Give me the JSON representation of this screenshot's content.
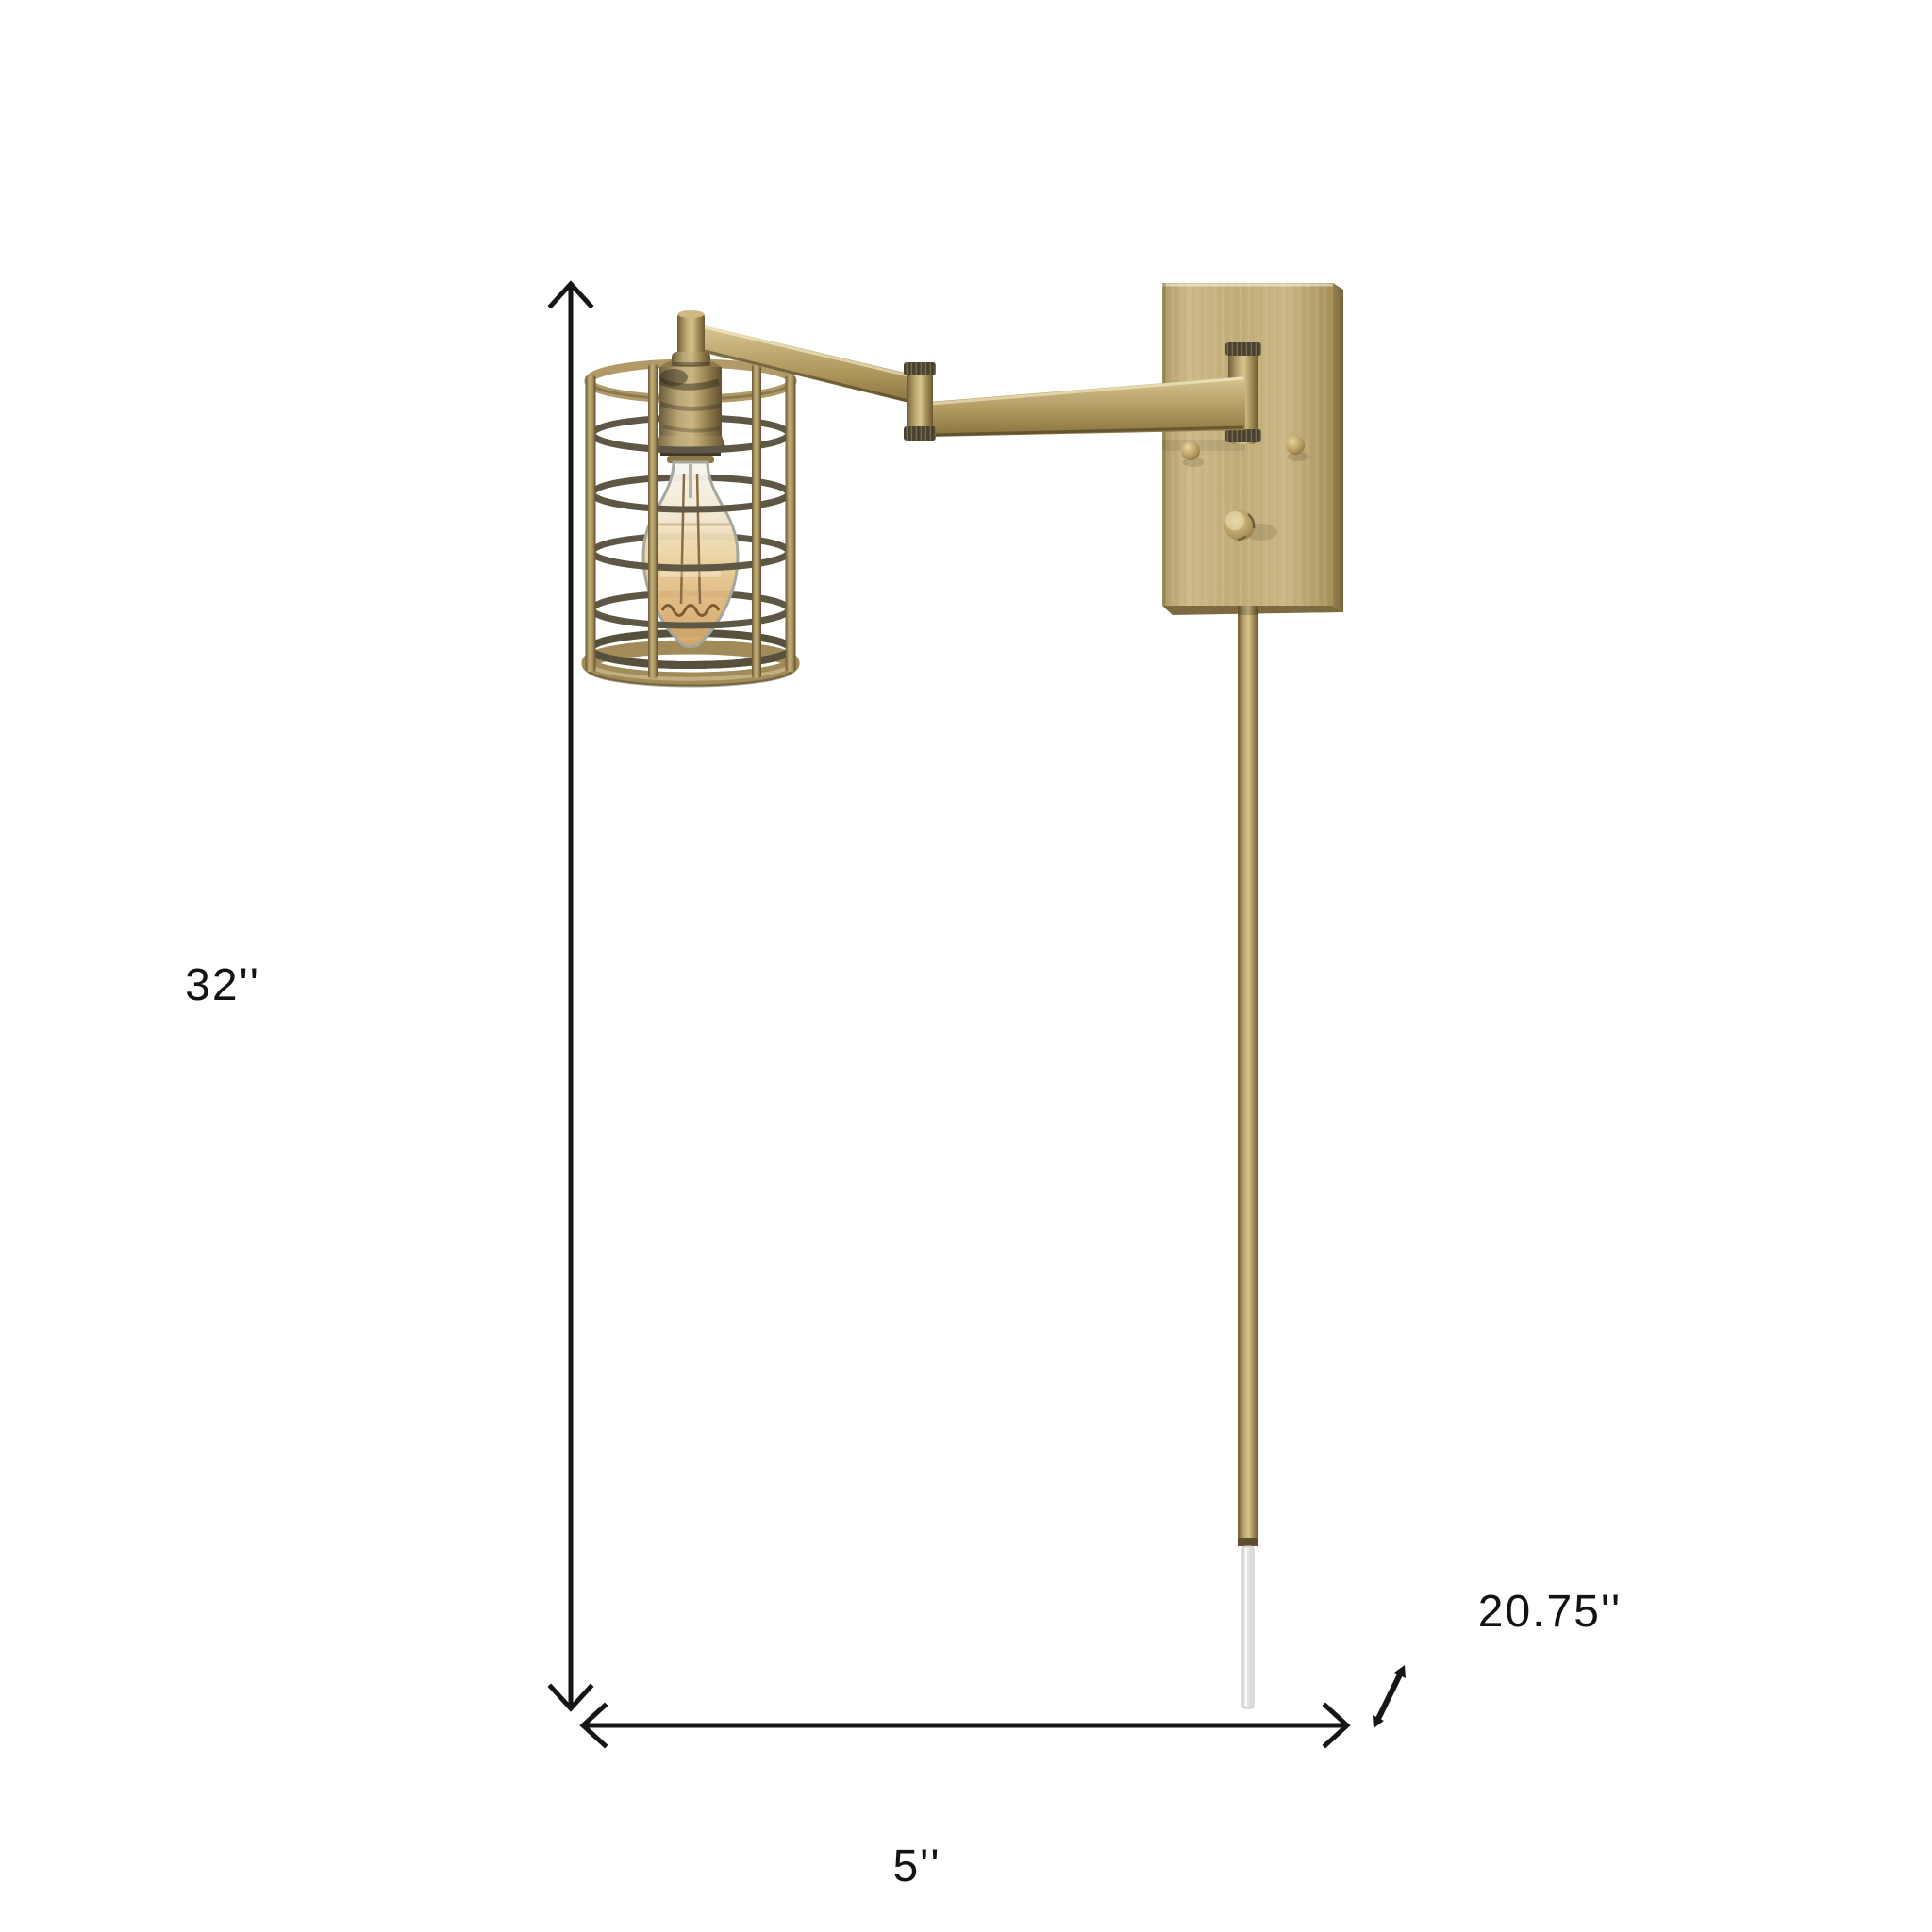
{
  "page": {
    "background_color": "#ffffff"
  },
  "diagram": {
    "kind": "product dimension diagram",
    "subject": "antique brass swing-arm plug-in wall sconce with cylindrical wire cage shade and Edison bulb",
    "annotations": {
      "height_label": "32''",
      "backplate_width_label": "5''",
      "cord_length_label": "20.75''"
    },
    "values": {
      "height_inches": 32,
      "width_inches": 5,
      "cord_inches": 20.75
    },
    "colors": {
      "dimension_lines": "#161616",
      "label_text": "#131313",
      "brass_highlight": "#d6c492",
      "brass_mid": "#bda873",
      "brass_shadow": "#7c6740",
      "cage_wire": "#5e5745",
      "bulb_amber": "#ddb478",
      "bulb_glass_edge": "#a6a69e",
      "cord": "#e4e4e2"
    }
  }
}
